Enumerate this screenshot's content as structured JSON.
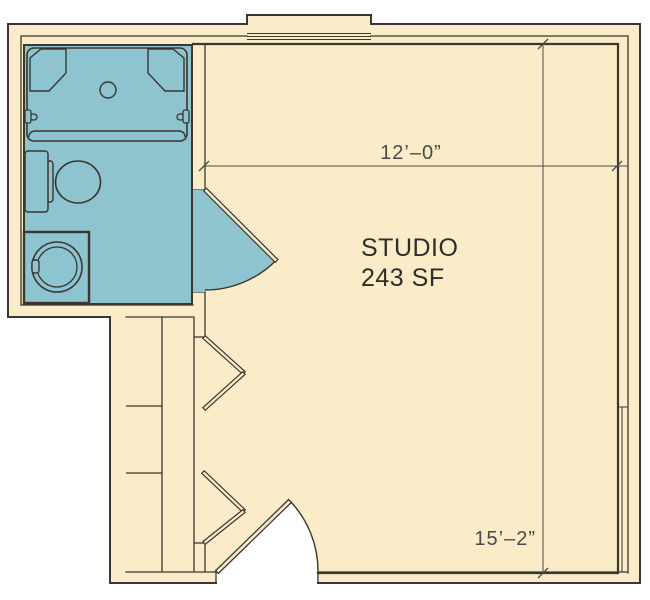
{
  "floor_plan": {
    "title": "studio-apartment-floor-plan",
    "room_label": {
      "line1": "STUDIO",
      "line2": "243 SF"
    },
    "dimensions": {
      "width_label": "12’–0”",
      "height_label": "15’–2”"
    },
    "areas": [
      "bathroom",
      "studio",
      "closet"
    ],
    "fixtures": [
      "bathtub",
      "tub-pillow-left",
      "tub-pillow-right",
      "tub-drain",
      "grab-bar-left",
      "grab-bar-right",
      "toilet-tank",
      "toilet-bowl",
      "washer",
      "closet-shelves",
      "bifold-door-upper",
      "bifold-door-lower",
      "bathroom-swing-door",
      "entry-swing-door",
      "bay-window"
    ],
    "colors": {
      "background": "#ffffff",
      "floor": "#fbecc9",
      "wet_area": "#8ec3d0",
      "wall_line": "#3a372f",
      "dimension": "#4a4a4a",
      "label": "#2e2d2b"
    }
  }
}
